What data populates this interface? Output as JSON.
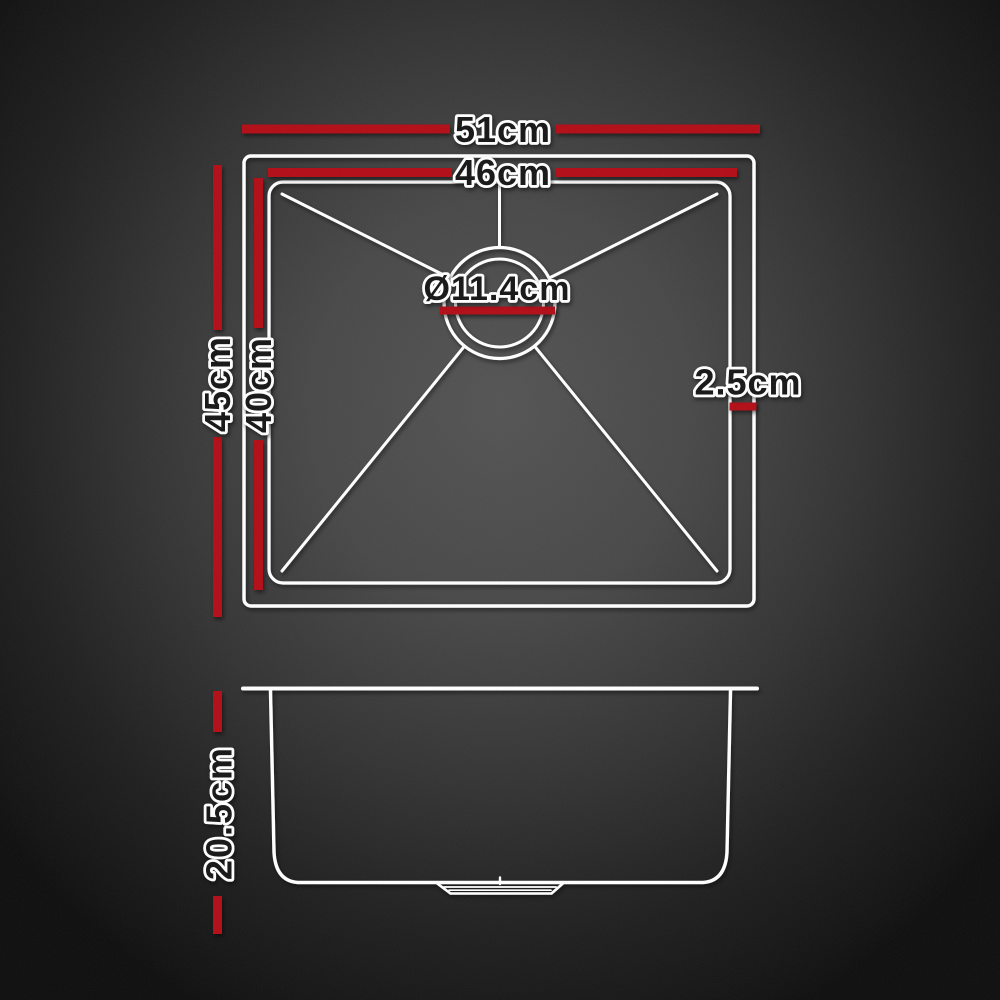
{
  "diagram": {
    "kind": "product-dimension-diagram",
    "colors": {
      "dimension_red": "#b30d12",
      "line_white": "#ffffff",
      "label_fill": "#191919",
      "label_outline": "#ffffff"
    },
    "top_view": {
      "outer_width": "51cm",
      "inner_width": "46cm",
      "outer_depth": "45cm",
      "inner_depth": "40cm",
      "drain_diameter": "Ø11.4cm",
      "rim_width": "2.5cm"
    },
    "side_view": {
      "bowl_height": "20.5cm"
    }
  }
}
